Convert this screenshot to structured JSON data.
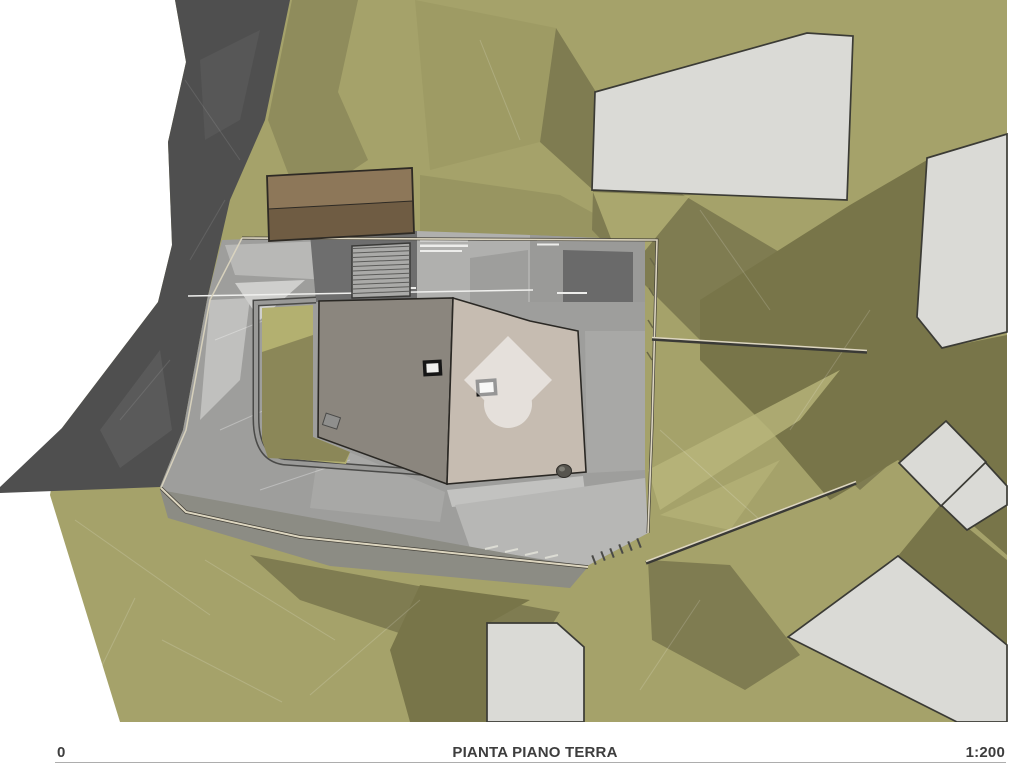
{
  "palette": {
    "page-bg": "#ffffff",
    "terrain": "#a5a26a",
    "terrain-shadow": "#7f7c51",
    "terrain-shadow-deep": "#787549",
    "terrain-highlight": "#b9b67c",
    "road": "#4f4f4f",
    "paving": "#9e9e9c",
    "paving-light": "#c2c2c0",
    "terrace-dark": "#6e6e6e",
    "roof-left": "#8b867e",
    "roof-right": "#c6bcb1",
    "outbuilding-top": "#8d7759",
    "outbuilding-bottom": "#6f5c43",
    "building-fill": "#dadad6",
    "building-outline": "#3b3b35",
    "boundary-line": "#ddd6c0",
    "garden-light": "#b3b070",
    "garden-dark": "#8b8758",
    "text": "#3d3d3d"
  },
  "footer": {
    "scale_origin": "0",
    "title": "PIANTA PIANO TERRA",
    "scale_ratio": "1:200"
  },
  "watermark": {
    "icon": "house-logo-watermark",
    "opacity": 0.55
  }
}
